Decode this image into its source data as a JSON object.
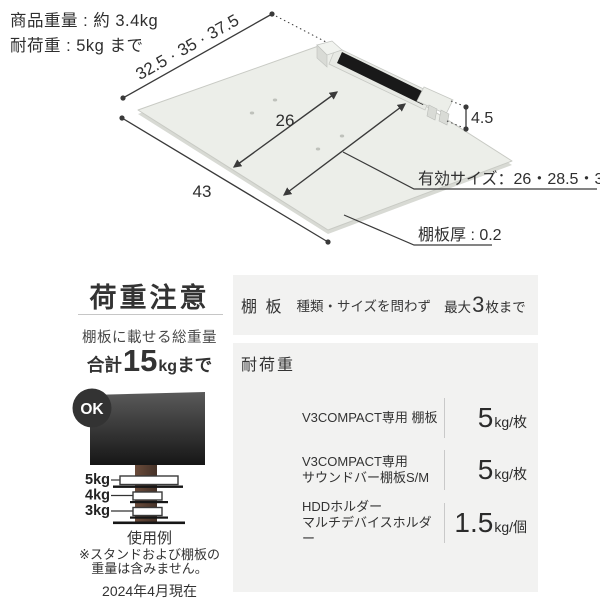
{
  "header": {
    "product_weight": "商品重量 : 約 3.4kg",
    "load_capacity": "耐荷重 : 5kg まで"
  },
  "diagram": {
    "dim_depth": "32.5 · 35 · 37.5",
    "dim_width": "43",
    "dim_inner": "26",
    "dim_height": "4.5",
    "effective_size": "有効サイズ：26・28.5・31",
    "board_thickness": "棚板厚 : 0.2"
  },
  "caution": {
    "title": "荷重注意",
    "subtitle": "棚板に載せる総重量",
    "total_prefix": "合計",
    "total_value": "15",
    "total_unit": "kg",
    "total_suffix": "まで",
    "ok_badge": "OK",
    "shelf_weights": [
      "5kg",
      "4kg",
      "3kg"
    ],
    "example_caption": "使用例",
    "note_line1": "※スタンドおよび棚板の",
    "note_line2": "重量は含みません。",
    "as_of_date": "2024年4月現在"
  },
  "spec": {
    "shelf_row": {
      "header": "棚 板",
      "condition": "種類・サイズを問わず",
      "max_prefix": "最大",
      "max_count": "3",
      "max_suffix": "枚まで"
    },
    "load_header": "耐荷重",
    "load_rows": [
      {
        "label1": "V3COMPACT専用 棚板",
        "label2": "",
        "num": "5",
        "unit": "kg/枚"
      },
      {
        "label1": "V3COMPACT専用",
        "label2": "サウンドバー棚板S/M",
        "num": "5",
        "unit": "kg/枚"
      },
      {
        "label1": "HDDホルダー",
        "label2": "マルチデバイスホルダー",
        "num": "1.5",
        "unit": "kg/個"
      }
    ]
  },
  "colors": {
    "text": "#333333",
    "panel_bg": "#f2f2f1",
    "board_surface": "#eceee9",
    "slot_black": "#191919",
    "ok_badge_bg": "#333333",
    "pole_brown": "#5b4134",
    "tv_dark": "#1d1d1d"
  }
}
